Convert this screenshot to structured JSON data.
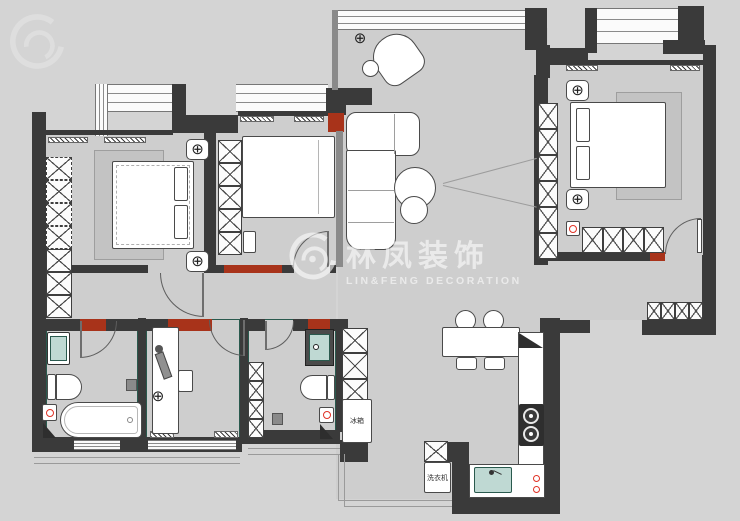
{
  "watermark": {
    "brand_cn": "林凤装饰",
    "brand_en": "LIN&FENG DECORATION"
  },
  "labels": {
    "fridge": "冰箱",
    "washer": "洗衣机"
  },
  "icons": {
    "crosshair": "⊕"
  },
  "colors": {
    "bg": "#d4d4d4",
    "floor": "#cecece",
    "wall": "#3a3a3a",
    "wallmid": "#8a8a8a",
    "red": "#a8331a",
    "redring": "#e03226",
    "teal": "#2a5a4e",
    "tealfill": "#bfd9d3",
    "rug": "#c3c3c3",
    "dark": "#2e2e2e",
    "line": "#6b6b6b"
  }
}
